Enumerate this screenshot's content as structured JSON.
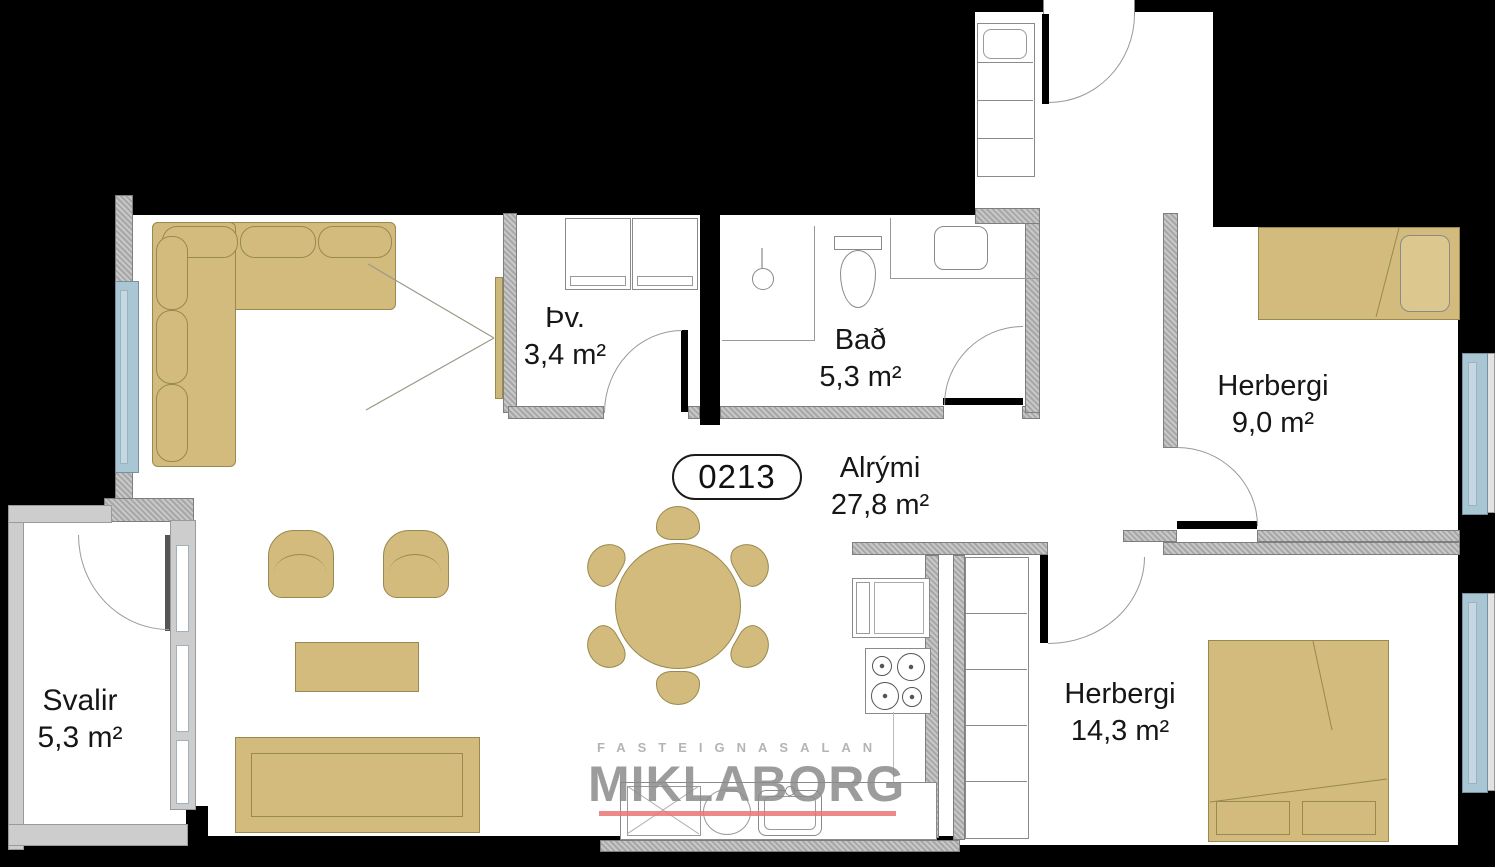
{
  "unit": {
    "number": "0213"
  },
  "rooms": {
    "laundry": {
      "name": "Þv.",
      "area": "3,4 m²"
    },
    "bathroom": {
      "name": "Bað",
      "area": "5,3 m²"
    },
    "living_area": {
      "name": "Alrými",
      "area": "27,8 m²"
    },
    "bedroom_small": {
      "name": "Herbergi",
      "area": "9,0 m²"
    },
    "bedroom_large": {
      "name": "Herbergi",
      "area": "14,3 m²"
    },
    "balcony": {
      "name": "Svalir",
      "area": "5,3 m²"
    }
  },
  "watermark": {
    "tagline": "FASTEIGNASALAN",
    "brand": "MIKLABORG"
  },
  "colors": {
    "background": "#000000",
    "floor": "#ffffff",
    "wall_gray": "#b5b5b5",
    "furniture_tan": "#d2bb7d",
    "window_blue": "#a9c6d5",
    "watermark_red": "#e97575"
  }
}
